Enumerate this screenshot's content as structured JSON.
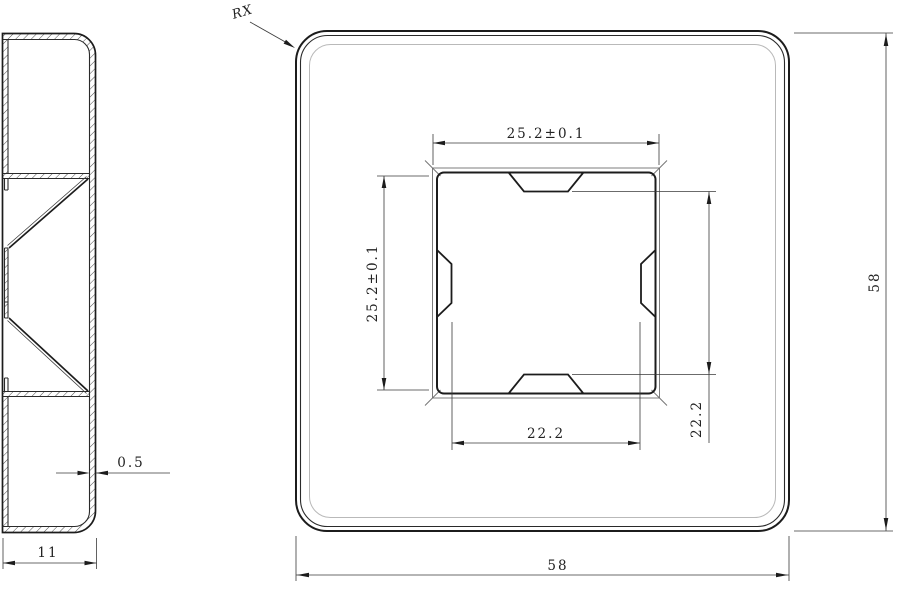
{
  "colors": {
    "line": "#1c1c1c",
    "faint_contour": "#b9b9b9",
    "background": "#ffffff"
  },
  "side_view": {
    "dimensions": {
      "wall_thickness": "0.5",
      "overall_width": "11"
    }
  },
  "front_view": {
    "corner_radius_note": "RX",
    "dimensions": {
      "opening_width": "25.2±0.1",
      "opening_height": "25.2±0.1",
      "inner_span_width": "22.2",
      "inner_span_height": "22.2",
      "overall_width": "58",
      "overall_height": "58"
    }
  }
}
